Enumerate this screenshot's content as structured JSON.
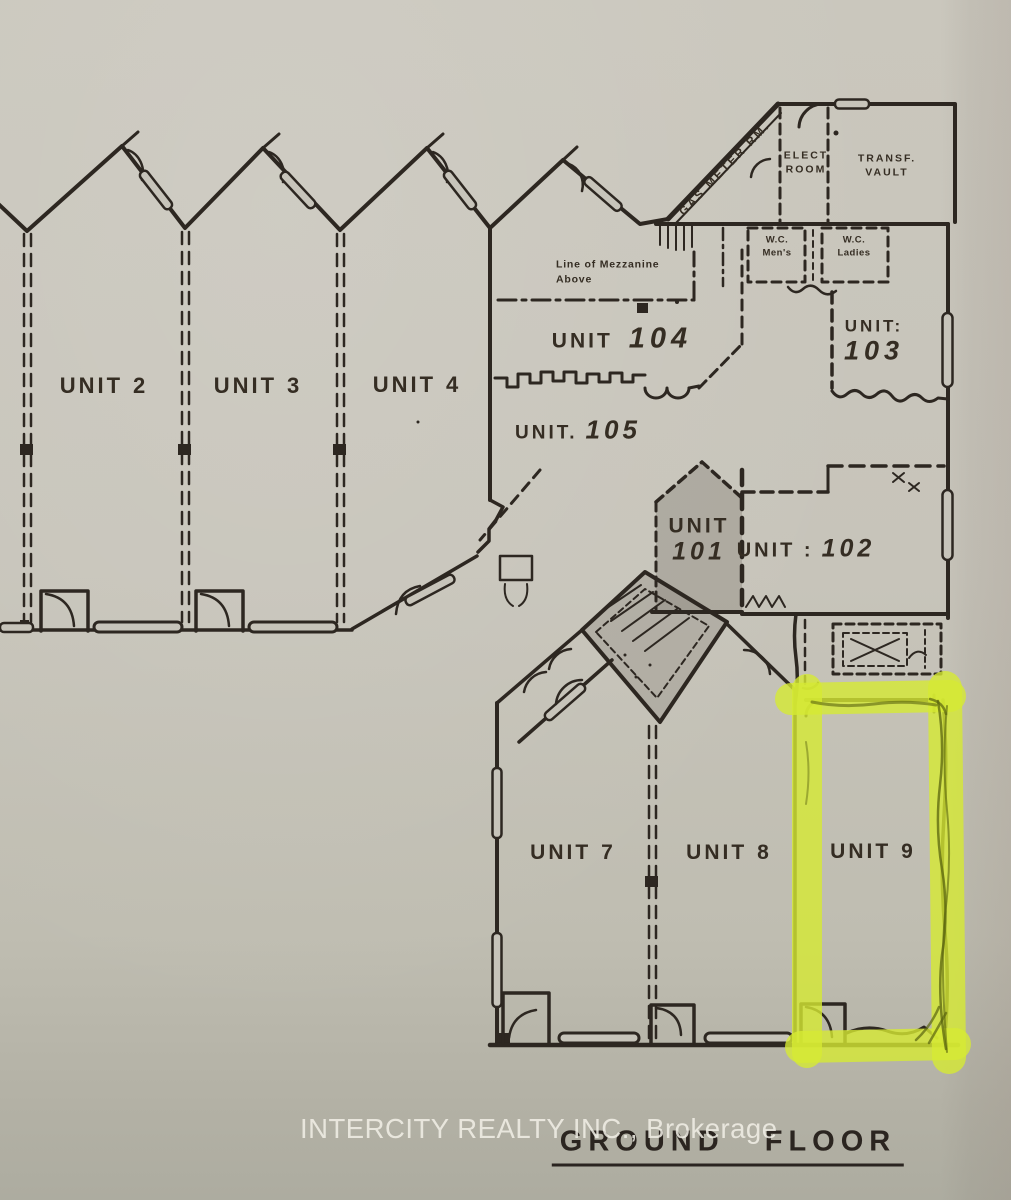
{
  "page": {
    "paper_color": "#c7c4ba",
    "ink_color": "#2d2721"
  },
  "floorplan": {
    "floor_label": "GROUND FLOOR",
    "watermark": "INTERCITY REALTY INC., Brokerage",
    "highlight": {
      "unit": "UNIT 9",
      "marker_color": "#d6ea33"
    },
    "units": [
      {
        "id": "unit-2",
        "prefix": "UNIT",
        "number": "2"
      },
      {
        "id": "unit-3",
        "prefix": "UNIT",
        "number": "3"
      },
      {
        "id": "unit-4",
        "prefix": "UNIT",
        "number": "4"
      },
      {
        "id": "unit-104",
        "prefix": "UNIT",
        "number": "104"
      },
      {
        "id": "unit-105",
        "prefix": "UNIT.",
        "number": "105"
      },
      {
        "id": "unit-101",
        "prefix": "UNIT",
        "number": "101"
      },
      {
        "id": "unit-102",
        "prefix": "UNIT :",
        "number": "102"
      },
      {
        "id": "unit-103",
        "prefix": "UNIT:",
        "number": "103"
      },
      {
        "id": "unit-7",
        "prefix": "UNIT",
        "number": "7"
      },
      {
        "id": "unit-8",
        "prefix": "UNIT",
        "number": "8"
      },
      {
        "id": "unit-9",
        "prefix": "UNIT",
        "number": "9"
      }
    ],
    "rooms": {
      "gas_meter": {
        "label": "GAS METER RM."
      },
      "elect": {
        "line1": "ELECT",
        "line2": "ROOM"
      },
      "transf": {
        "line1": "TRANSF.",
        "line2": "VAULT"
      },
      "wc_mens": {
        "line1": "W.C.",
        "line2": "Men's"
      },
      "wc_ladies": {
        "line1": "W.C.",
        "line2": "Ladies"
      }
    },
    "notes": {
      "mezzanine": {
        "line1": "Line of Mezzanine",
        "line2": "Above"
      }
    }
  }
}
